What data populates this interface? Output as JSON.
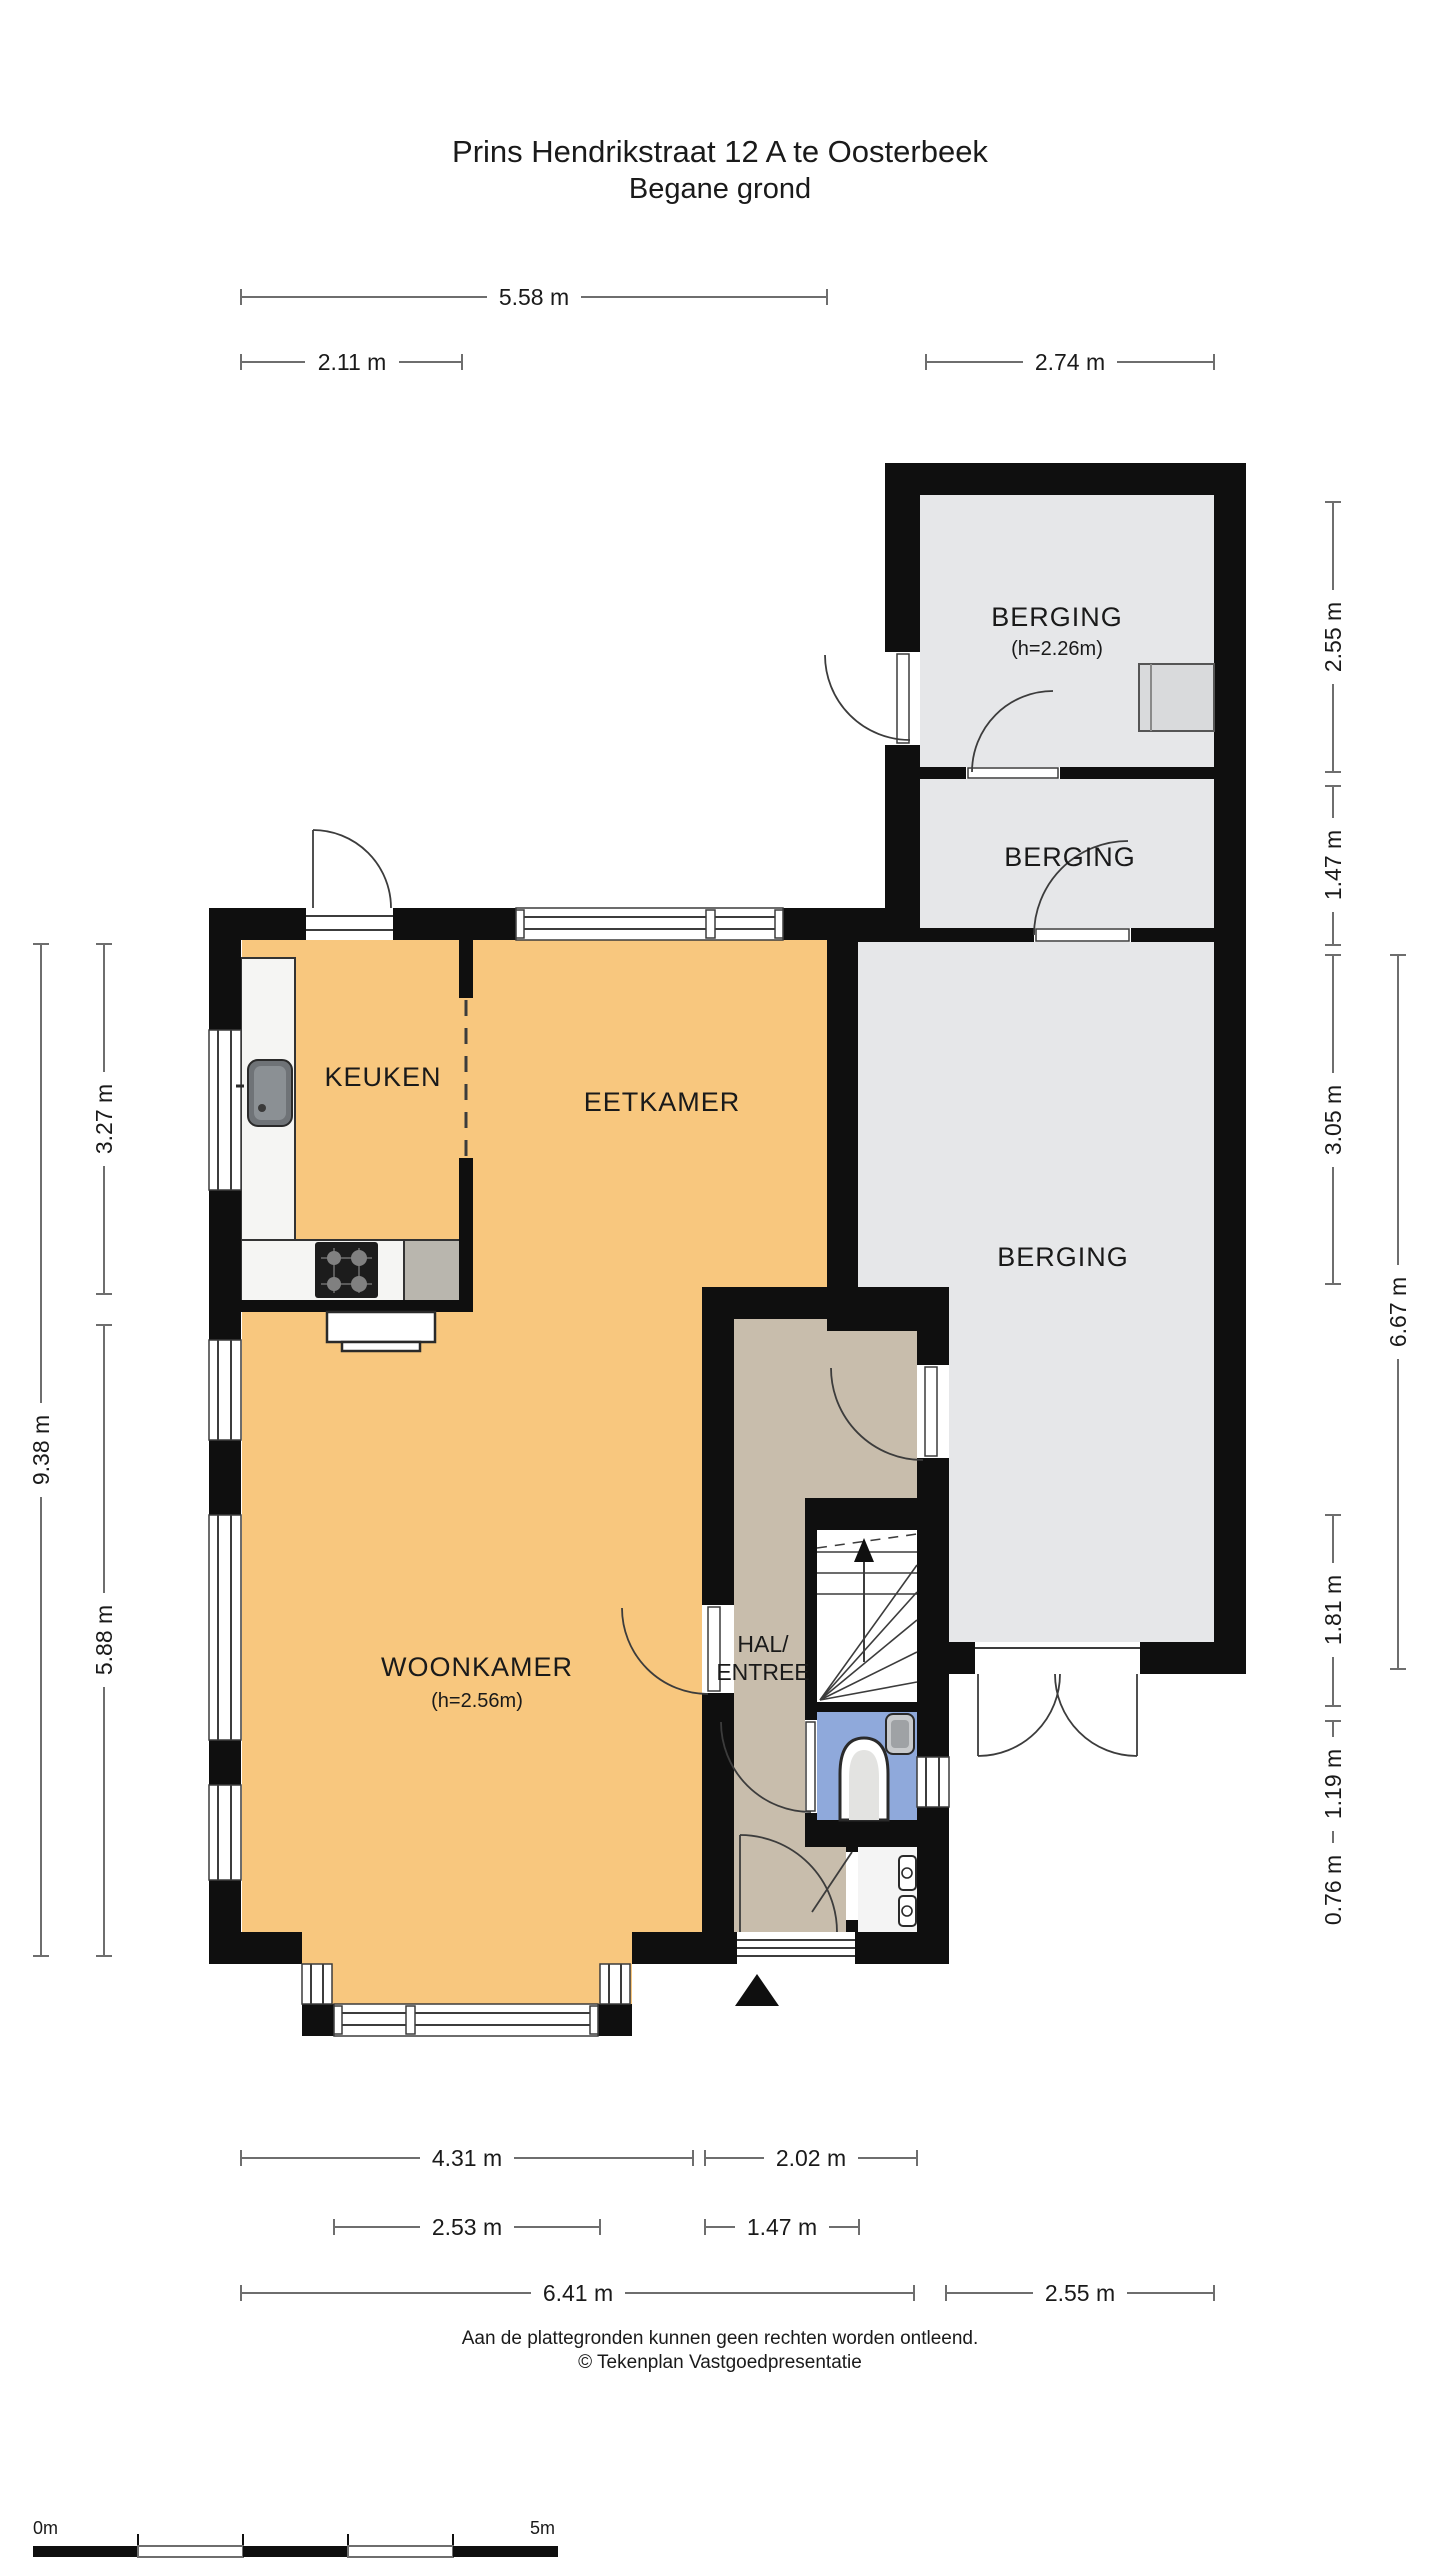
{
  "colors": {
    "wall": "#0f0f0f",
    "floor_living": "#F8C77E",
    "floor_storage": "#E6E7E9",
    "floor_hall": "#C8BDAC",
    "floor_toilet": "#8FA9DB",
    "counter": "#B9B6AE",
    "fixture_gray": "#D9DADC",
    "line": "#3c3c3c",
    "dim": "#6e6e6e"
  },
  "title": {
    "line1": "Prins Hendrikstraat 12 A te Oosterbeek",
    "line2": "Begane grond"
  },
  "rooms": {
    "berging_top": {
      "label": "BERGING",
      "height": "(h=2.26m)"
    },
    "berging_mid": {
      "label": "BERGING"
    },
    "berging_large": {
      "label": "BERGING"
    },
    "keuken": {
      "label": "KEUKEN"
    },
    "eetkamer": {
      "label": "EETKAMER"
    },
    "woonkamer": {
      "label": "WOONKAMER",
      "height": "(h=2.56m)"
    },
    "hal": {
      "line1": "HAL/",
      "line2": "ENTREE"
    }
  },
  "dimensions": {
    "top_total": "5.58 m",
    "top_left": "2.11 m",
    "top_right": "2.74 m",
    "left_total": "9.38 m",
    "left_upper": "3.27 m",
    "left_lower": "5.88 m",
    "right_berging_top": "2.55 m",
    "right_berging_mid": "1.47 m",
    "right_berging_large": "3.05 m",
    "right_total": "6.67 m",
    "right_stairs": "1.81 m",
    "right_toilet": "1.19 m",
    "right_meterkast": "0.76 m",
    "bottom_woonkamer": "4.31 m",
    "bottom_hal": "2.02 m",
    "bottom_bay": "2.53 m",
    "bottom_entry": "1.47 m",
    "bottom_total": "6.41 m",
    "bottom_berging": "2.55 m"
  },
  "footer": {
    "line1": "Aan de plattegronden kunnen geen rechten worden ontleend.",
    "line2": "© Tekenplan Vastgoedpresentatie"
  },
  "scale_bar": {
    "start": "0m",
    "end": "5m"
  }
}
